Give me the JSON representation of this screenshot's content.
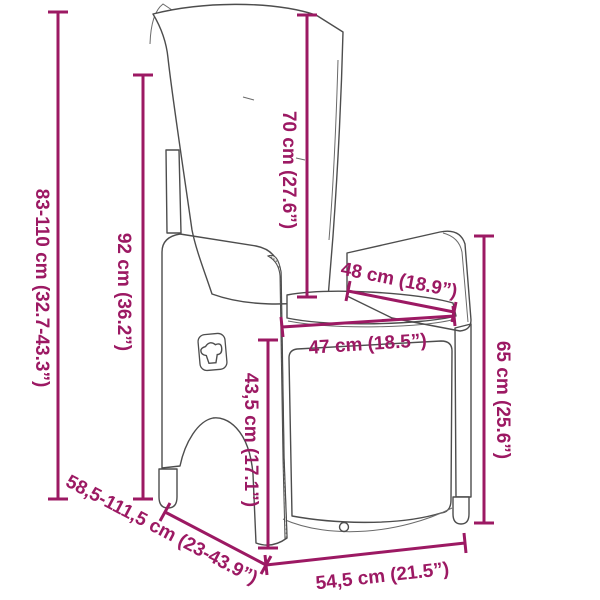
{
  "diagram": {
    "accent_color": "#9C1963",
    "illustration": "reclining-wicker-garden-chair-with-cushions",
    "dims": [
      {
        "name": "total-height-range",
        "label": "83-110 cm (32.7-43.3”)"
      },
      {
        "name": "backrest-height",
        "label": "92 cm (36.2”)"
      },
      {
        "name": "back-cushion-height",
        "label": "70 cm (27.6”)"
      },
      {
        "name": "armrest-length",
        "label": "48 cm (18.9”)"
      },
      {
        "name": "seat-width",
        "label": "47 cm (18.5”)"
      },
      {
        "name": "seat-front-height",
        "label": "43,5 cm (17.1”)"
      },
      {
        "name": "side-height",
        "label": "65 cm (25.6”)"
      },
      {
        "name": "depth-range",
        "label": "58,5-111,5 cm (23-43.9”)"
      },
      {
        "name": "base-width",
        "label": "54,5 cm (21.5”)"
      }
    ]
  }
}
